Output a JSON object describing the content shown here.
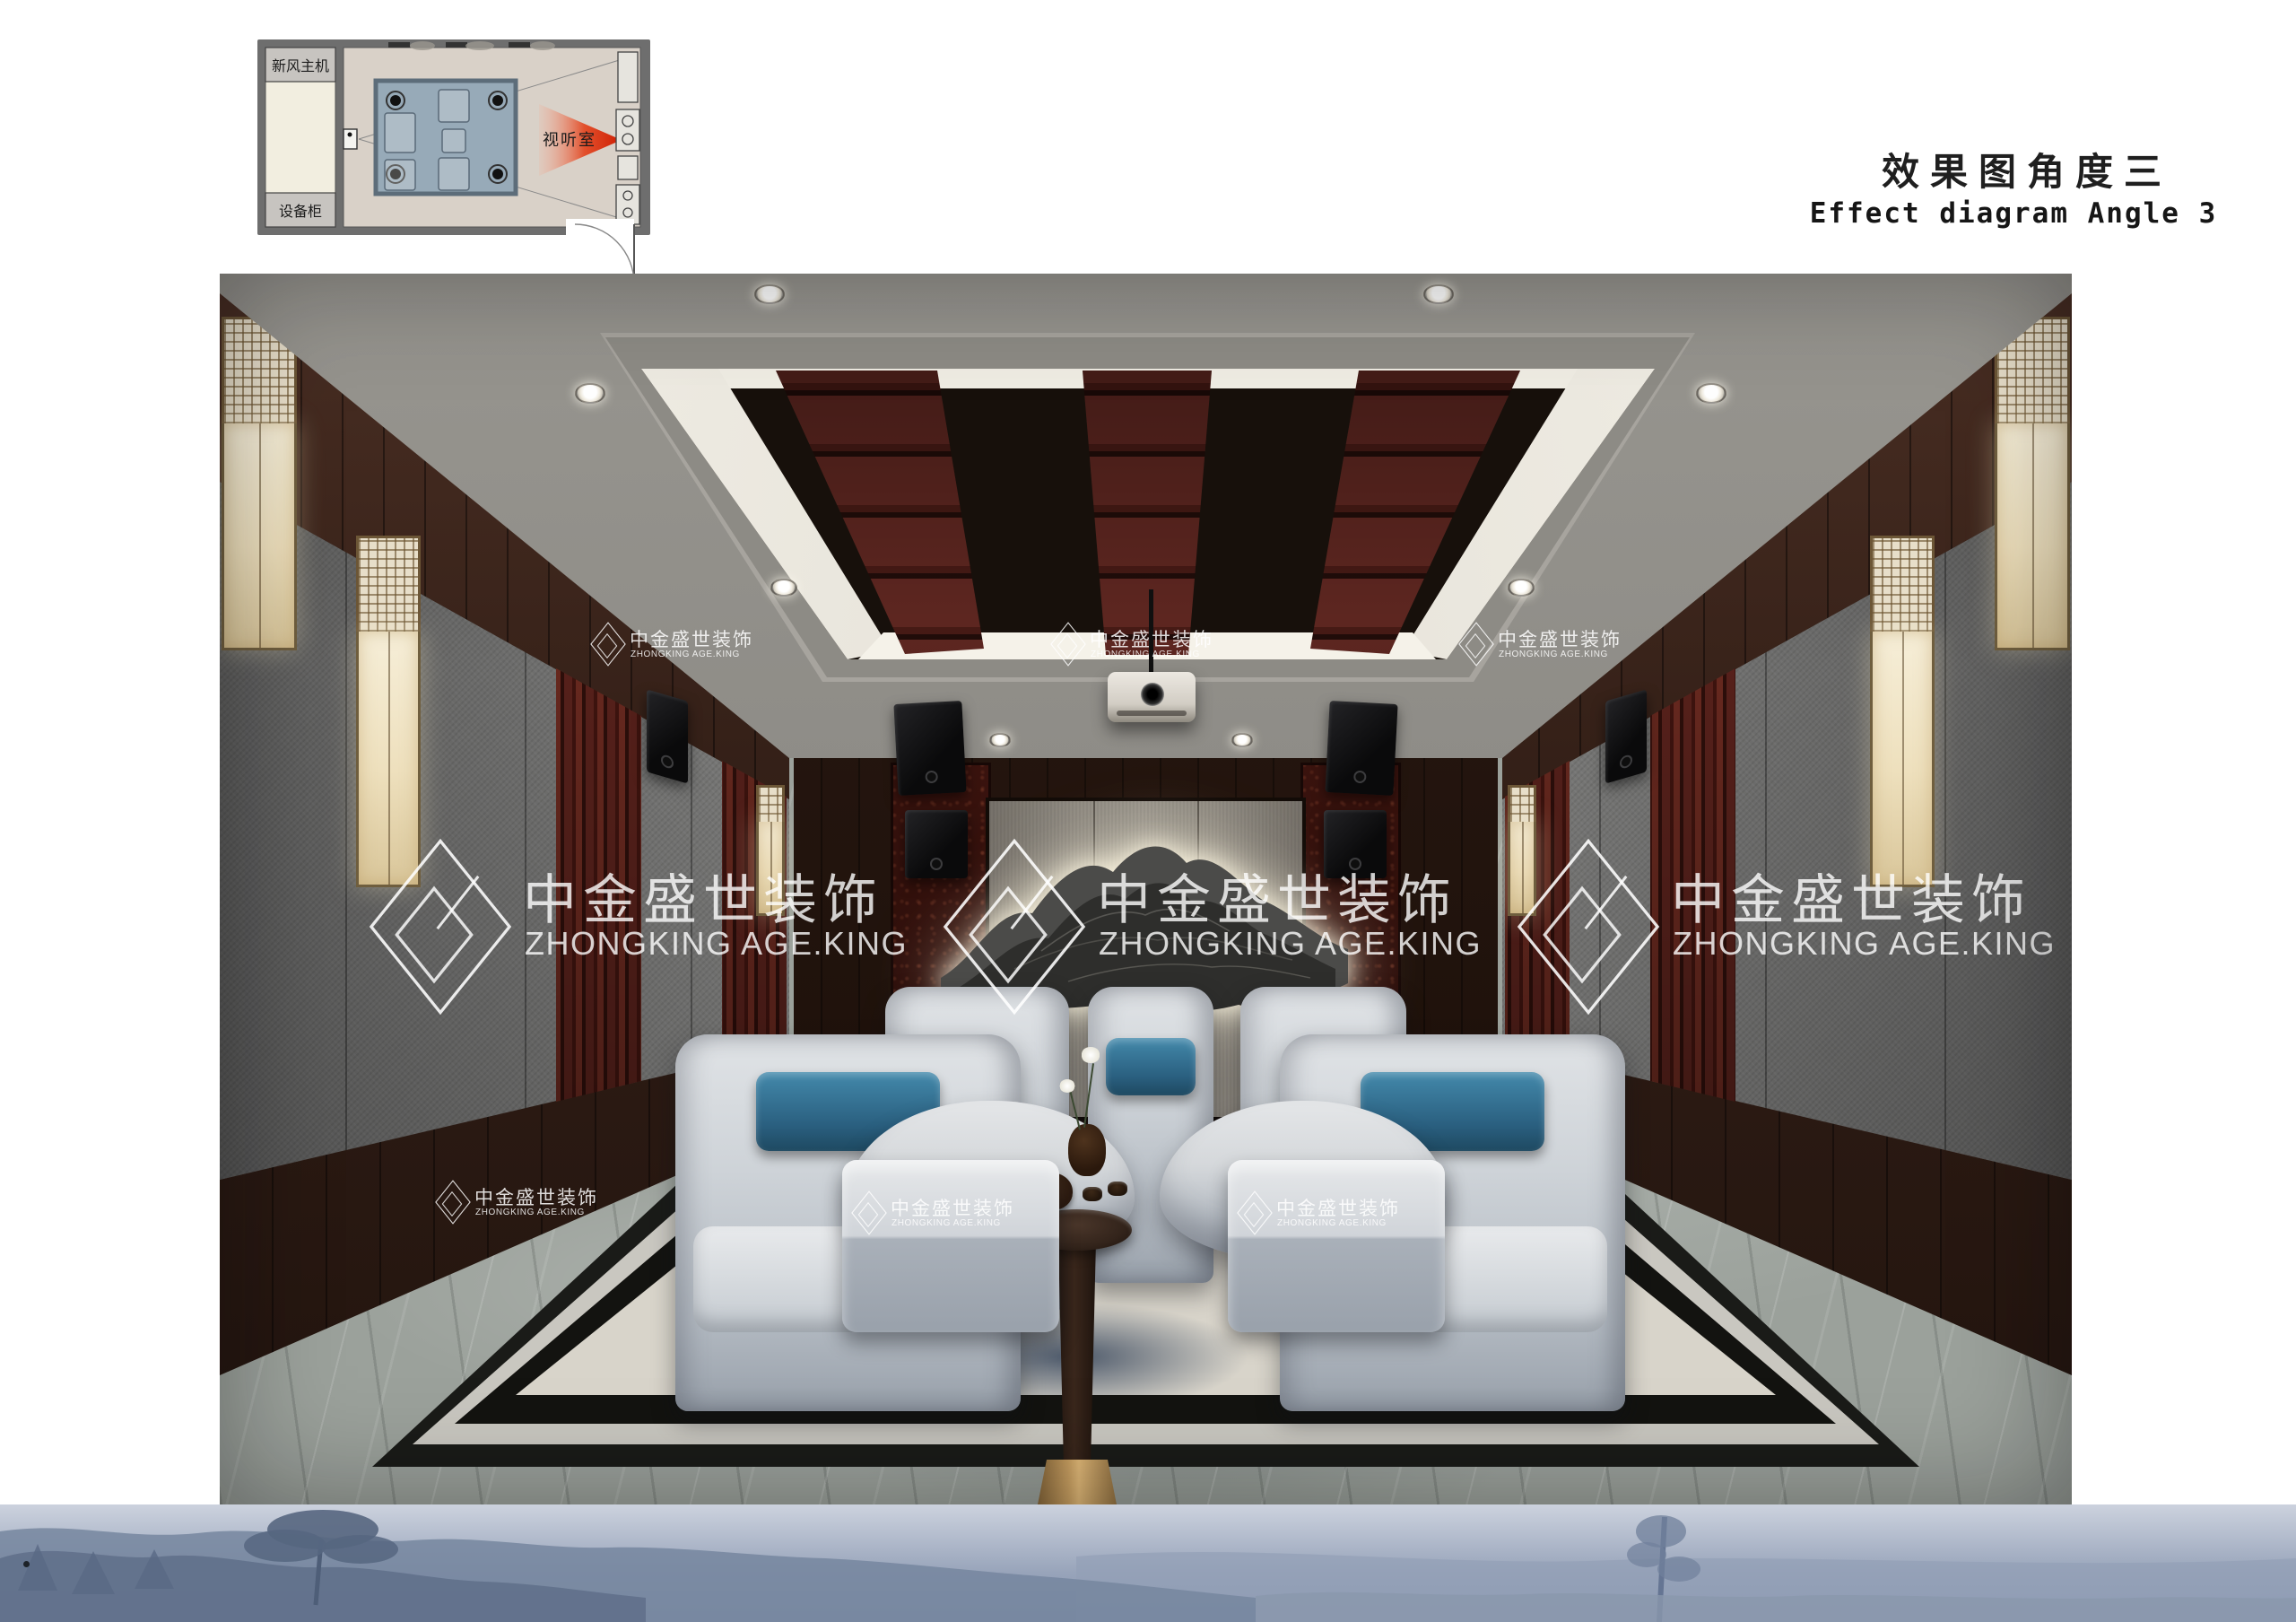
{
  "header": {
    "title_cn": "效果图角度三",
    "title_en": "Effect diagram Angle 3"
  },
  "floorplan": {
    "label_fresh_air": "新风主机",
    "label_equipment": "设备柜",
    "label_av_room": "视听室"
  },
  "watermark": {
    "brand_cn": "中金盛世装饰",
    "brand_en": "ZHONGKING AGE.KING"
  },
  "colors": {
    "arrow_red": "#d23007",
    "plan_wall_gray": "#6e6e6e",
    "plan_platform_blue": "#97aab8",
    "pillow_blue": "#2f6b8f",
    "ceiling_baffle_red": "#5d2620",
    "lantern_cream": "#f0e6cb",
    "marble_gray": "#9ba19b",
    "footer_haze_blue": "#98a4ba",
    "watermark_white": "#ffffff"
  }
}
